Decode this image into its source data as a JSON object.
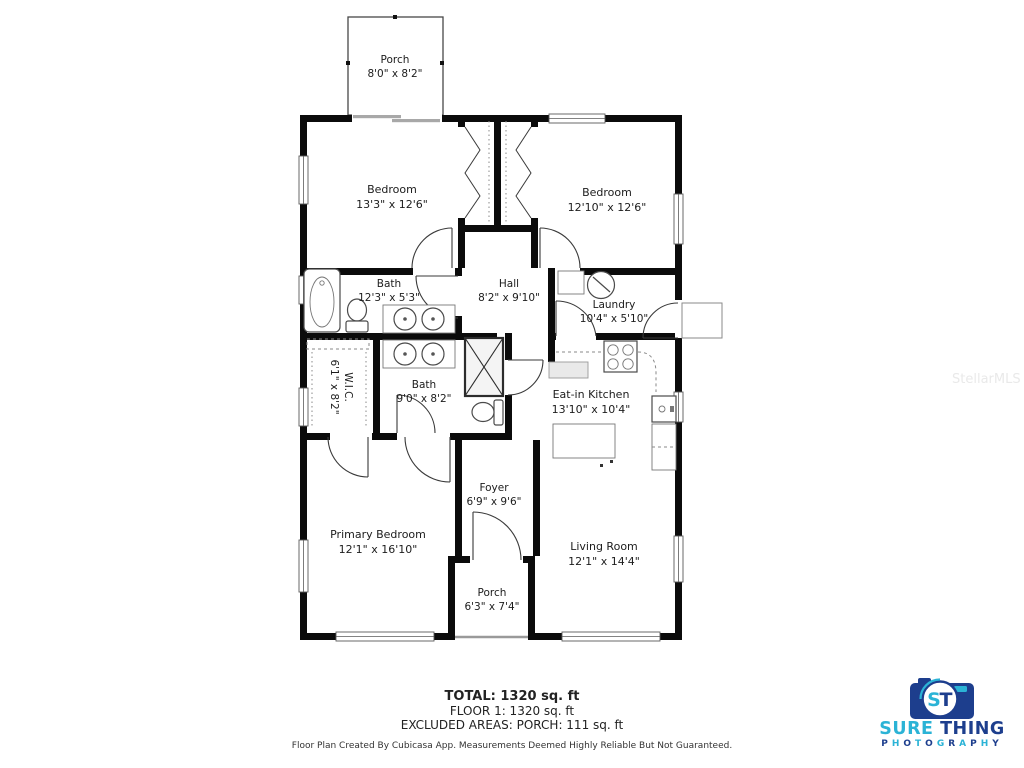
{
  "rooms": [
    {
      "id": "porch-top",
      "name": "Porch",
      "dims": "8'0\" x 8'2\""
    },
    {
      "id": "bedroom-left",
      "name": "Bedroom",
      "dims": "13'3\" x 12'6\""
    },
    {
      "id": "bedroom-right",
      "name": "Bedroom",
      "dims": "12'10\" x 12'6\""
    },
    {
      "id": "bath-main",
      "name": "Bath",
      "dims": "12'3\" x 5'3\""
    },
    {
      "id": "hall",
      "name": "Hall",
      "dims": "8'2\" x 9'10\""
    },
    {
      "id": "laundry",
      "name": "Laundry",
      "dims": "10'4\" x 5'10\""
    },
    {
      "id": "walk-in-closet",
      "name": "W.I.C.",
      "dims": "6'1\" x 8'2\""
    },
    {
      "id": "bath-second",
      "name": "Bath",
      "dims": "9'0\" x 8'2\""
    },
    {
      "id": "eat-in-kitchen",
      "name": "Eat-in Kitchen",
      "dims": "13'10\" x 10'4\""
    },
    {
      "id": "foyer",
      "name": "Foyer",
      "dims": "6'9\" x 9'6\""
    },
    {
      "id": "primary-bedroom",
      "name": "Primary Bedroom",
      "dims": "12'1\" x 16'10\""
    },
    {
      "id": "living-room",
      "name": "Living Room",
      "dims": "12'1\" x 14'4\""
    },
    {
      "id": "porch-bottom",
      "name": "Porch",
      "dims": "6'3\" x 7'4\""
    }
  ],
  "summary": {
    "total": "TOTAL: 1320 sq. ft",
    "floor1": "FLOOR 1: 1320 sq. ft",
    "excluded": "EXCLUDED AREAS: PORCH: 111 sq. ft",
    "disclaimer": "Floor Plan Created By Cubicasa App. Measurements Deemed Highly Reliable But Not Guaranteed."
  },
  "watermark": "StellarMLS",
  "logo": {
    "monogram_s": "S",
    "monogram_t": "T",
    "word1": "SURE",
    "word2": "THING",
    "word3": "PHOTOGRAPHY",
    "colors": {
      "cyan": "#2bb3d6",
      "navy": "#1d3e8d"
    }
  }
}
